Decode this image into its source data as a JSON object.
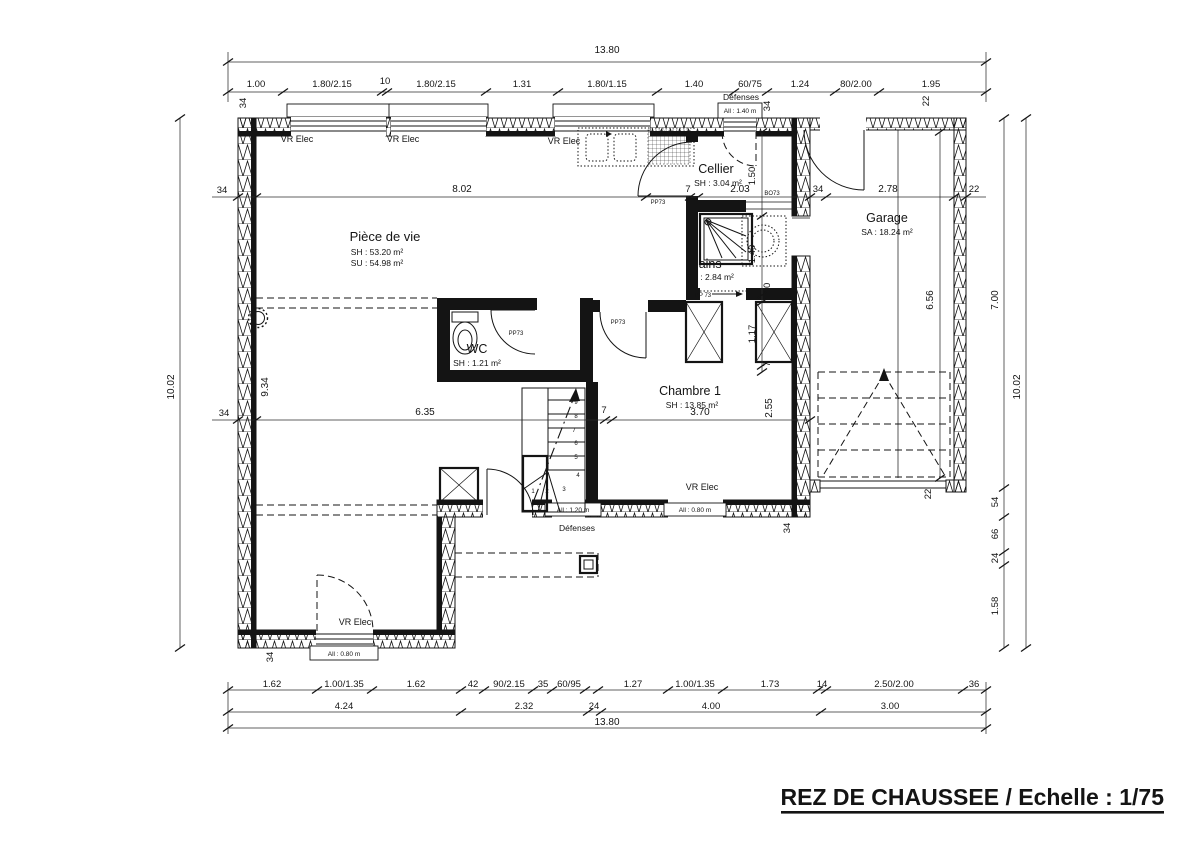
{
  "title": "REZ DE CHAUSSEE / Echelle : 1/75",
  "rooms": {
    "piece": {
      "name": "Pièce de vie",
      "sh": "SH : 53.20 m²",
      "su": "SU : 54.98 m²"
    },
    "cellier": {
      "name": "Cellier",
      "sh": "SH : 3.04 m²"
    },
    "bains": {
      "name": "Bains",
      "sh": "SH : 2.84 m²"
    },
    "wc": {
      "name": "WC",
      "sh": "SH : 1.21 m²"
    },
    "chambre": {
      "name": "Chambre 1",
      "sh": "SH : 13.85 m²"
    },
    "garage": {
      "name": "Garage",
      "sa": "SA : 18.24 m²"
    }
  },
  "labels": {
    "vr_elec": "VR Elec",
    "defenses": "Défenses",
    "all140": "All : 1.40 m",
    "all120": "All : 1.20 m",
    "all080": "All : 0.80 m",
    "pp73": "PP73",
    "pp73s": "PP 73",
    "bo73": "BO73"
  },
  "dims": {
    "top_total": "13.80",
    "top": [
      "1.00",
      "1.80/2.15",
      "10",
      "1.80/2.15",
      "1.31",
      "1.80/1.15",
      "1.40",
      "60/75",
      "1.24",
      "80/2.00",
      "1.95"
    ],
    "bot1": [
      "1.62",
      "1.00/1.35",
      "1.62",
      "42",
      "90/2.15",
      "35",
      "60/95",
      "1.27",
      "1.00/1.35",
      "1.73",
      "14",
      "2.50/2.00",
      "36"
    ],
    "bot2": [
      "4.24",
      "2.32",
      "24",
      "4.00",
      "3.00"
    ],
    "bot_total": "13.80",
    "left_total": "10.02",
    "left_inner": "9.34",
    "right_total": "10.02",
    "right_upper": "7.00",
    "right_garage": "6.56",
    "right_lower": [
      "54",
      "66",
      "24",
      "1.58"
    ],
    "h1": {
      "a": "8.02",
      "b": "7",
      "c": "2.03",
      "d": "2.78"
    },
    "h2": {
      "a": "6.35",
      "b": "7",
      "c": "3.70",
      "d": "2.55"
    },
    "v": {
      "a": "1.50",
      "b": "1.40",
      "c": "10",
      "d": "1.17",
      "e": "7"
    },
    "t34": "34",
    "t22": "22",
    "stairs": [
      "1",
      "2",
      "3",
      "4",
      "5",
      "6",
      "7",
      "8",
      "9"
    ]
  }
}
